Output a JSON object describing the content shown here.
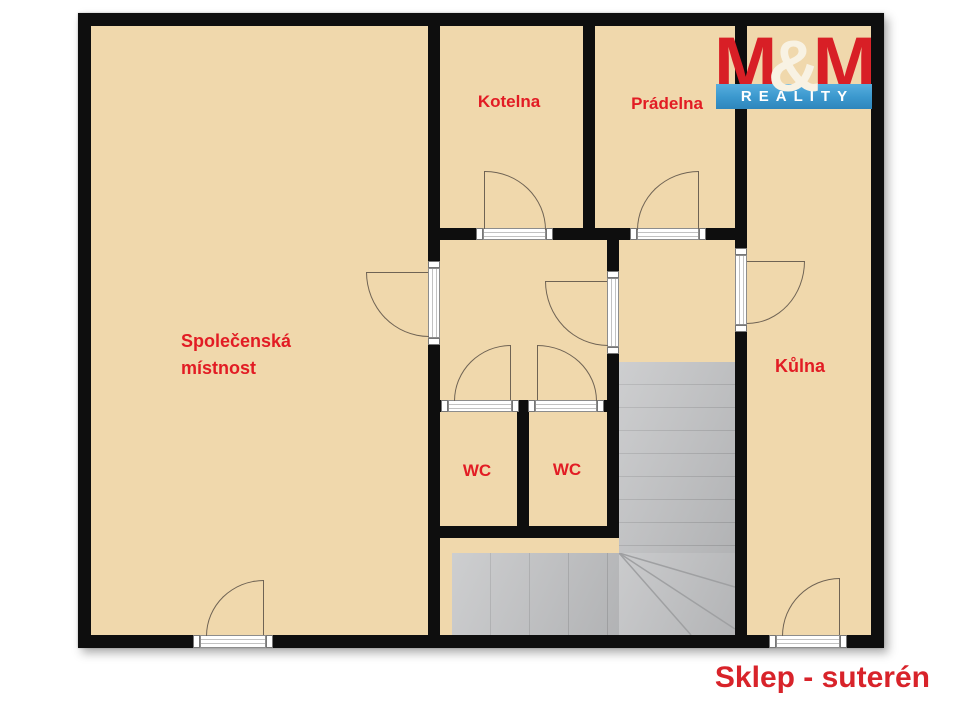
{
  "caption": {
    "text": "Sklep - suterén"
  },
  "logo": {
    "m_left": "M",
    "ampersand": "&",
    "m_right": "M",
    "banner": "REALITY"
  },
  "rooms": {
    "spolecenska": {
      "line1": "Společenská",
      "line2": "místnost"
    },
    "kotelna": {
      "label": "Kotelna"
    },
    "pradelna": {
      "label": "Prádelna"
    },
    "kulna": {
      "label": "Kůlna"
    },
    "wc_left": {
      "label": "WC"
    },
    "wc_right": {
      "label": "WC"
    }
  },
  "colors": {
    "floor_beige": "#f0d8ac",
    "wall_black": "#0e0e0e",
    "room_label_red": "#e21c24",
    "caption_red": "#d8232a",
    "stairs_gray": "#bdbec0",
    "stair_tread_line": "#a5a6a8",
    "door_line_brown": "#6f6354",
    "door_frame_white": "#ffffff",
    "logo_red": "#d81f26",
    "logo_blue": "#3a97cd",
    "logo_cream": "#f8f2e3"
  }
}
